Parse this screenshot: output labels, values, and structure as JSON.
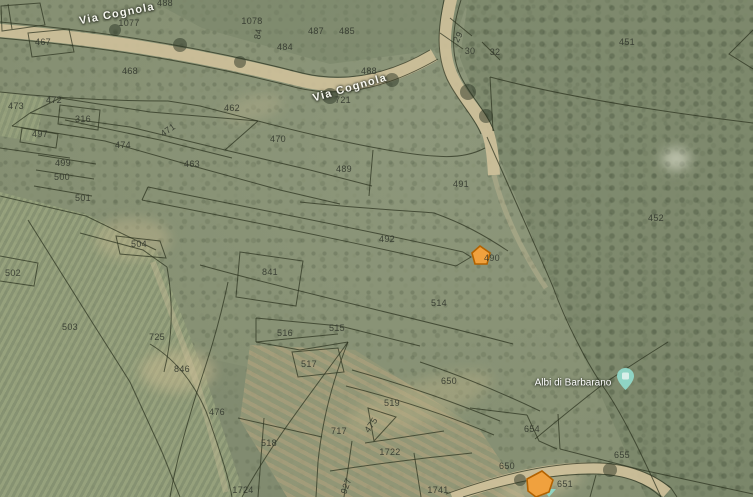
{
  "map": {
    "kind": "satellite-cadastral-view",
    "road_labels": [
      {
        "text": "Via Cognola",
        "x": 117,
        "y": 14,
        "r": -11
      },
      {
        "text": "Via Cognola",
        "x": 350,
        "y": 88,
        "r": -16
      }
    ],
    "place": {
      "label": "Albi di Barbarano",
      "x": 573,
      "y": 383
    },
    "marker": {
      "color": "#8fd4c4",
      "inner": "#d9efe9"
    },
    "highlight": {
      "fill": "#f0a13e",
      "stroke": "#b36200"
    },
    "parcel_labels": [
      {
        "t": "467",
        "x": 43,
        "y": 42
      },
      {
        "t": "1077",
        "x": 129,
        "y": 23
      },
      {
        "t": "488",
        "x": 165,
        "y": 3
      },
      {
        "t": "468",
        "x": 130,
        "y": 71
      },
      {
        "t": "1078",
        "x": 252,
        "y": 21
      },
      {
        "t": "84",
        "x": 258,
        "y": 34,
        "r": -80
      },
      {
        "t": "487",
        "x": 316,
        "y": 31
      },
      {
        "t": "485",
        "x": 347,
        "y": 31
      },
      {
        "t": "484",
        "x": 285,
        "y": 47
      },
      {
        "t": "488",
        "x": 369,
        "y": 71
      },
      {
        "t": "721",
        "x": 343,
        "y": 100
      },
      {
        "t": "462",
        "x": 232,
        "y": 108
      },
      {
        "t": "29",
        "x": 458,
        "y": 37,
        "r": -62
      },
      {
        "t": "30",
        "x": 470,
        "y": 51
      },
      {
        "t": "32",
        "x": 495,
        "y": 52
      },
      {
        "t": "451",
        "x": 627,
        "y": 42
      },
      {
        "t": "473",
        "x": 16,
        "y": 106
      },
      {
        "t": "472",
        "x": 54,
        "y": 100
      },
      {
        "t": "316",
        "x": 83,
        "y": 119
      },
      {
        "t": "497",
        "x": 40,
        "y": 134
      },
      {
        "t": "471",
        "x": 168,
        "y": 130,
        "r": -35
      },
      {
        "t": "474",
        "x": 123,
        "y": 145
      },
      {
        "t": "463",
        "x": 192,
        "y": 164
      },
      {
        "t": "470",
        "x": 278,
        "y": 139
      },
      {
        "t": "499",
        "x": 63,
        "y": 163
      },
      {
        "t": "500",
        "x": 62,
        "y": 177
      },
      {
        "t": "501",
        "x": 83,
        "y": 198
      },
      {
        "t": "489",
        "x": 344,
        "y": 169
      },
      {
        "t": "491",
        "x": 461,
        "y": 184
      },
      {
        "t": "452",
        "x": 656,
        "y": 218
      },
      {
        "t": "492",
        "x": 387,
        "y": 239
      },
      {
        "t": "490",
        "x": 492,
        "y": 258
      },
      {
        "t": "504",
        "x": 139,
        "y": 244
      },
      {
        "t": "502",
        "x": 13,
        "y": 273
      },
      {
        "t": "841",
        "x": 270,
        "y": 272
      },
      {
        "t": "514",
        "x": 439,
        "y": 303
      },
      {
        "t": "503",
        "x": 70,
        "y": 327
      },
      {
        "t": "725",
        "x": 157,
        "y": 337
      },
      {
        "t": "516",
        "x": 285,
        "y": 333
      },
      {
        "t": "515",
        "x": 337,
        "y": 328
      },
      {
        "t": "846",
        "x": 182,
        "y": 369
      },
      {
        "t": "476",
        "x": 217,
        "y": 412
      },
      {
        "t": "517",
        "x": 309,
        "y": 364
      },
      {
        "t": "519",
        "x": 392,
        "y": 403
      },
      {
        "t": "650",
        "x": 449,
        "y": 381
      },
      {
        "t": "654",
        "x": 532,
        "y": 429
      },
      {
        "t": "717",
        "x": 339,
        "y": 431
      },
      {
        "t": "475",
        "x": 371,
        "y": 425,
        "r": -55
      },
      {
        "t": "1722",
        "x": 390,
        "y": 452
      },
      {
        "t": "655",
        "x": 622,
        "y": 455
      },
      {
        "t": "518",
        "x": 269,
        "y": 443
      },
      {
        "t": "650",
        "x": 507,
        "y": 466
      },
      {
        "t": "927",
        "x": 346,
        "y": 486,
        "r": -70
      },
      {
        "t": "1724",
        "x": 243,
        "y": 490
      },
      {
        "t": "1741",
        "x": 438,
        "y": 490
      },
      {
        "t": "651",
        "x": 565,
        "y": 484
      }
    ]
  }
}
